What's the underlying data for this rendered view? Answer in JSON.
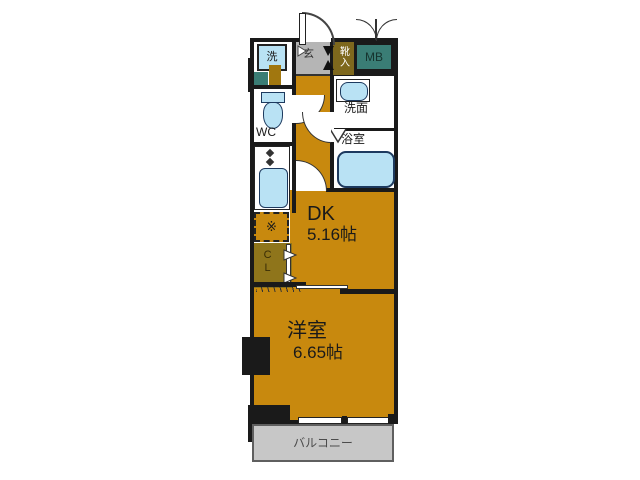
{
  "floorplan": {
    "rooms": {
      "dk": {
        "label": "DK",
        "size": "5.16帖"
      },
      "western": {
        "label": "洋室",
        "size": "6.65帖"
      },
      "balcony": {
        "label": "バルコニー"
      },
      "wc": {
        "label": "WC"
      },
      "washroom": {
        "label": "洗面"
      },
      "bathroom": {
        "label": "浴室"
      },
      "entrance": {
        "label": "玄"
      },
      "shoe_cabinet": {
        "label": "靴入"
      },
      "meter_box": {
        "label": "MB"
      },
      "closet": {
        "label": "CL"
      },
      "washer": {
        "label": "洗"
      },
      "stove": {
        "label": "※"
      }
    },
    "colors": {
      "floor_orange": "#c8890e",
      "closet_olive": "#8f751b",
      "shoe_olive": "#7e681d",
      "meter_teal": "#3a7d75",
      "fixture_blue": "#b9e2f4",
      "fixture_edge": "#1d3a5f",
      "entrance_gray": "#b5b5b5",
      "balcony_gray": "#c7c7c7",
      "wall_black": "#1a1a1a"
    }
  }
}
